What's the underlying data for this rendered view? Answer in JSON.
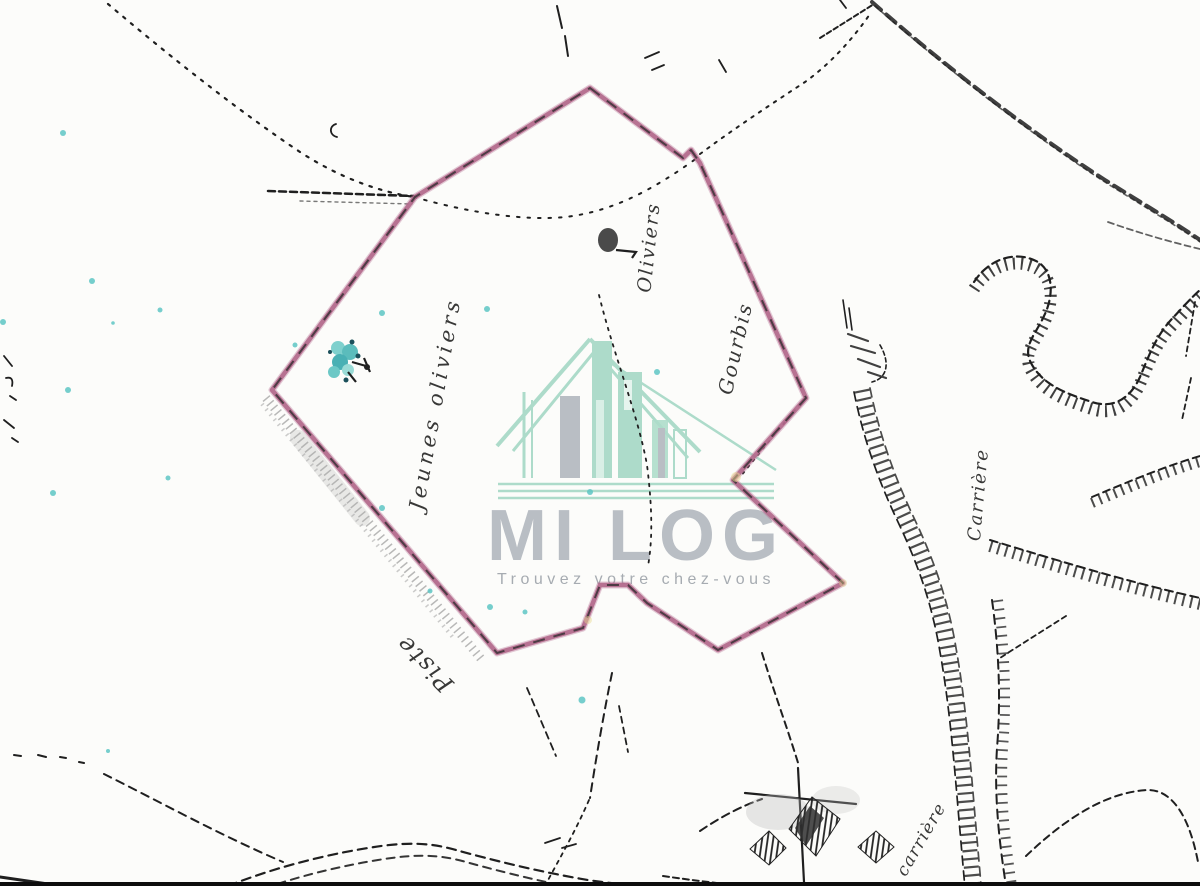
{
  "watermark": {
    "brand": "MI LOG",
    "tagline": "Trouvez votre chez-vous",
    "mint": "#a7d9c6",
    "gray": "#b4b9c0",
    "tagline_gray": "#9fa5ab"
  },
  "parcel": {
    "stroke": "#b2688b",
    "overdraw": "#2a2a2a",
    "points": "590,88 683,158 691,150 700,163 806,398 733,480 843,583 718,650 647,603 628,585 600,585 583,628 497,653 272,390 415,197"
  },
  "labels": [
    {
      "id": "oliviers",
      "text": "Oliviers"
    },
    {
      "id": "jeunes-oliviers",
      "text": "Jeunes oliviers"
    },
    {
      "id": "gourbis",
      "text": "Gourbis"
    },
    {
      "id": "piste",
      "text": "Piste"
    },
    {
      "id": "carriere-right",
      "text": "Carrière"
    },
    {
      "id": "carriere-bottom",
      "text": "carrière"
    }
  ],
  "colors": {
    "ink": "#1f1f1f",
    "teal_speck": "#5ec6c4",
    "paper": "#fcfcfa"
  }
}
